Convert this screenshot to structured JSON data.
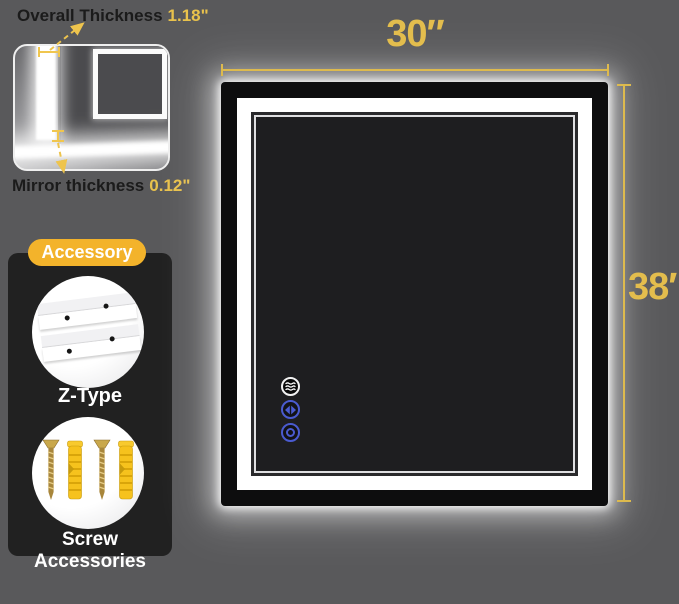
{
  "callouts": {
    "overall_thickness": {
      "label": "Overall Thickness",
      "value": "1.18\""
    },
    "mirror_thickness": {
      "label": "Mirror thickness",
      "value": "0.12\""
    }
  },
  "dimensions": {
    "width": "30″",
    "height": "38″"
  },
  "accessory": {
    "badge": "Accessory",
    "items": [
      {
        "icon": "z-bracket-icon",
        "label": "Z-Type"
      },
      {
        "icon": "screws-and-anchors-icon",
        "label": "Screw Accessories"
      }
    ]
  },
  "mirror": {
    "touch_buttons": [
      {
        "icon": "defog-icon"
      },
      {
        "icon": "light-color-diamond-icon"
      },
      {
        "icon": "power-ring-icon"
      }
    ]
  },
  "colors": {
    "background": "#59595b",
    "accent_yellow": "#e3bd4d",
    "badge_yellow": "#f3b32b",
    "button_blue": "#4a5bd0",
    "panel_black": "#212121",
    "led_white": "#ffffff",
    "mirror_surface": "#1e1e20"
  }
}
